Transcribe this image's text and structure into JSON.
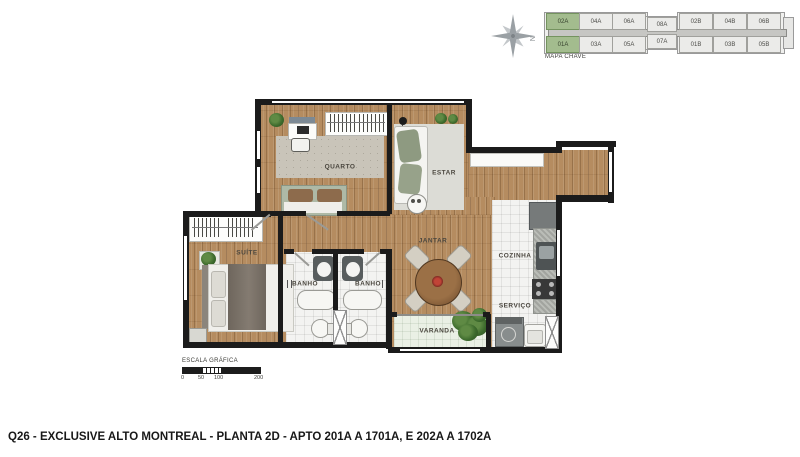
{
  "title": "Q26 - EXCLUSIVE ALTO MONTREAL - PLANTA 2D - APTO 201A A 1701A, E 202A A 1702A",
  "key_map": {
    "label": "MAPA CHAVE",
    "compass_letter": "N",
    "units_top": [
      "02A",
      "04A",
      "06A",
      "08A",
      "02B",
      "04B",
      "06B"
    ],
    "units_bottom": [
      "01A",
      "03A",
      "05A",
      "07A",
      "01B",
      "03B",
      "05B"
    ],
    "highlighted_units": [
      "02A",
      "01A"
    ]
  },
  "rooms": {
    "quarto": "QUARTO",
    "estar": "ESTAR",
    "suite": "SUÍTE",
    "banho_1": "BANHO",
    "banho_2": "BANHO",
    "jantar": "JANTAR",
    "cozinha": "COZINHA",
    "servico": "SERVIÇO",
    "varanda": "VARANDA"
  },
  "scale_bar": {
    "label": "ESCALA GRÁFICA",
    "ticks": [
      "0",
      "50",
      "100",
      "200"
    ]
  },
  "colors": {
    "highlight_green": "#a3bc8e",
    "wood_floor": "#b58c60",
    "wall": "#1b1b1b",
    "key_unit_fill": "#ebebe9"
  }
}
